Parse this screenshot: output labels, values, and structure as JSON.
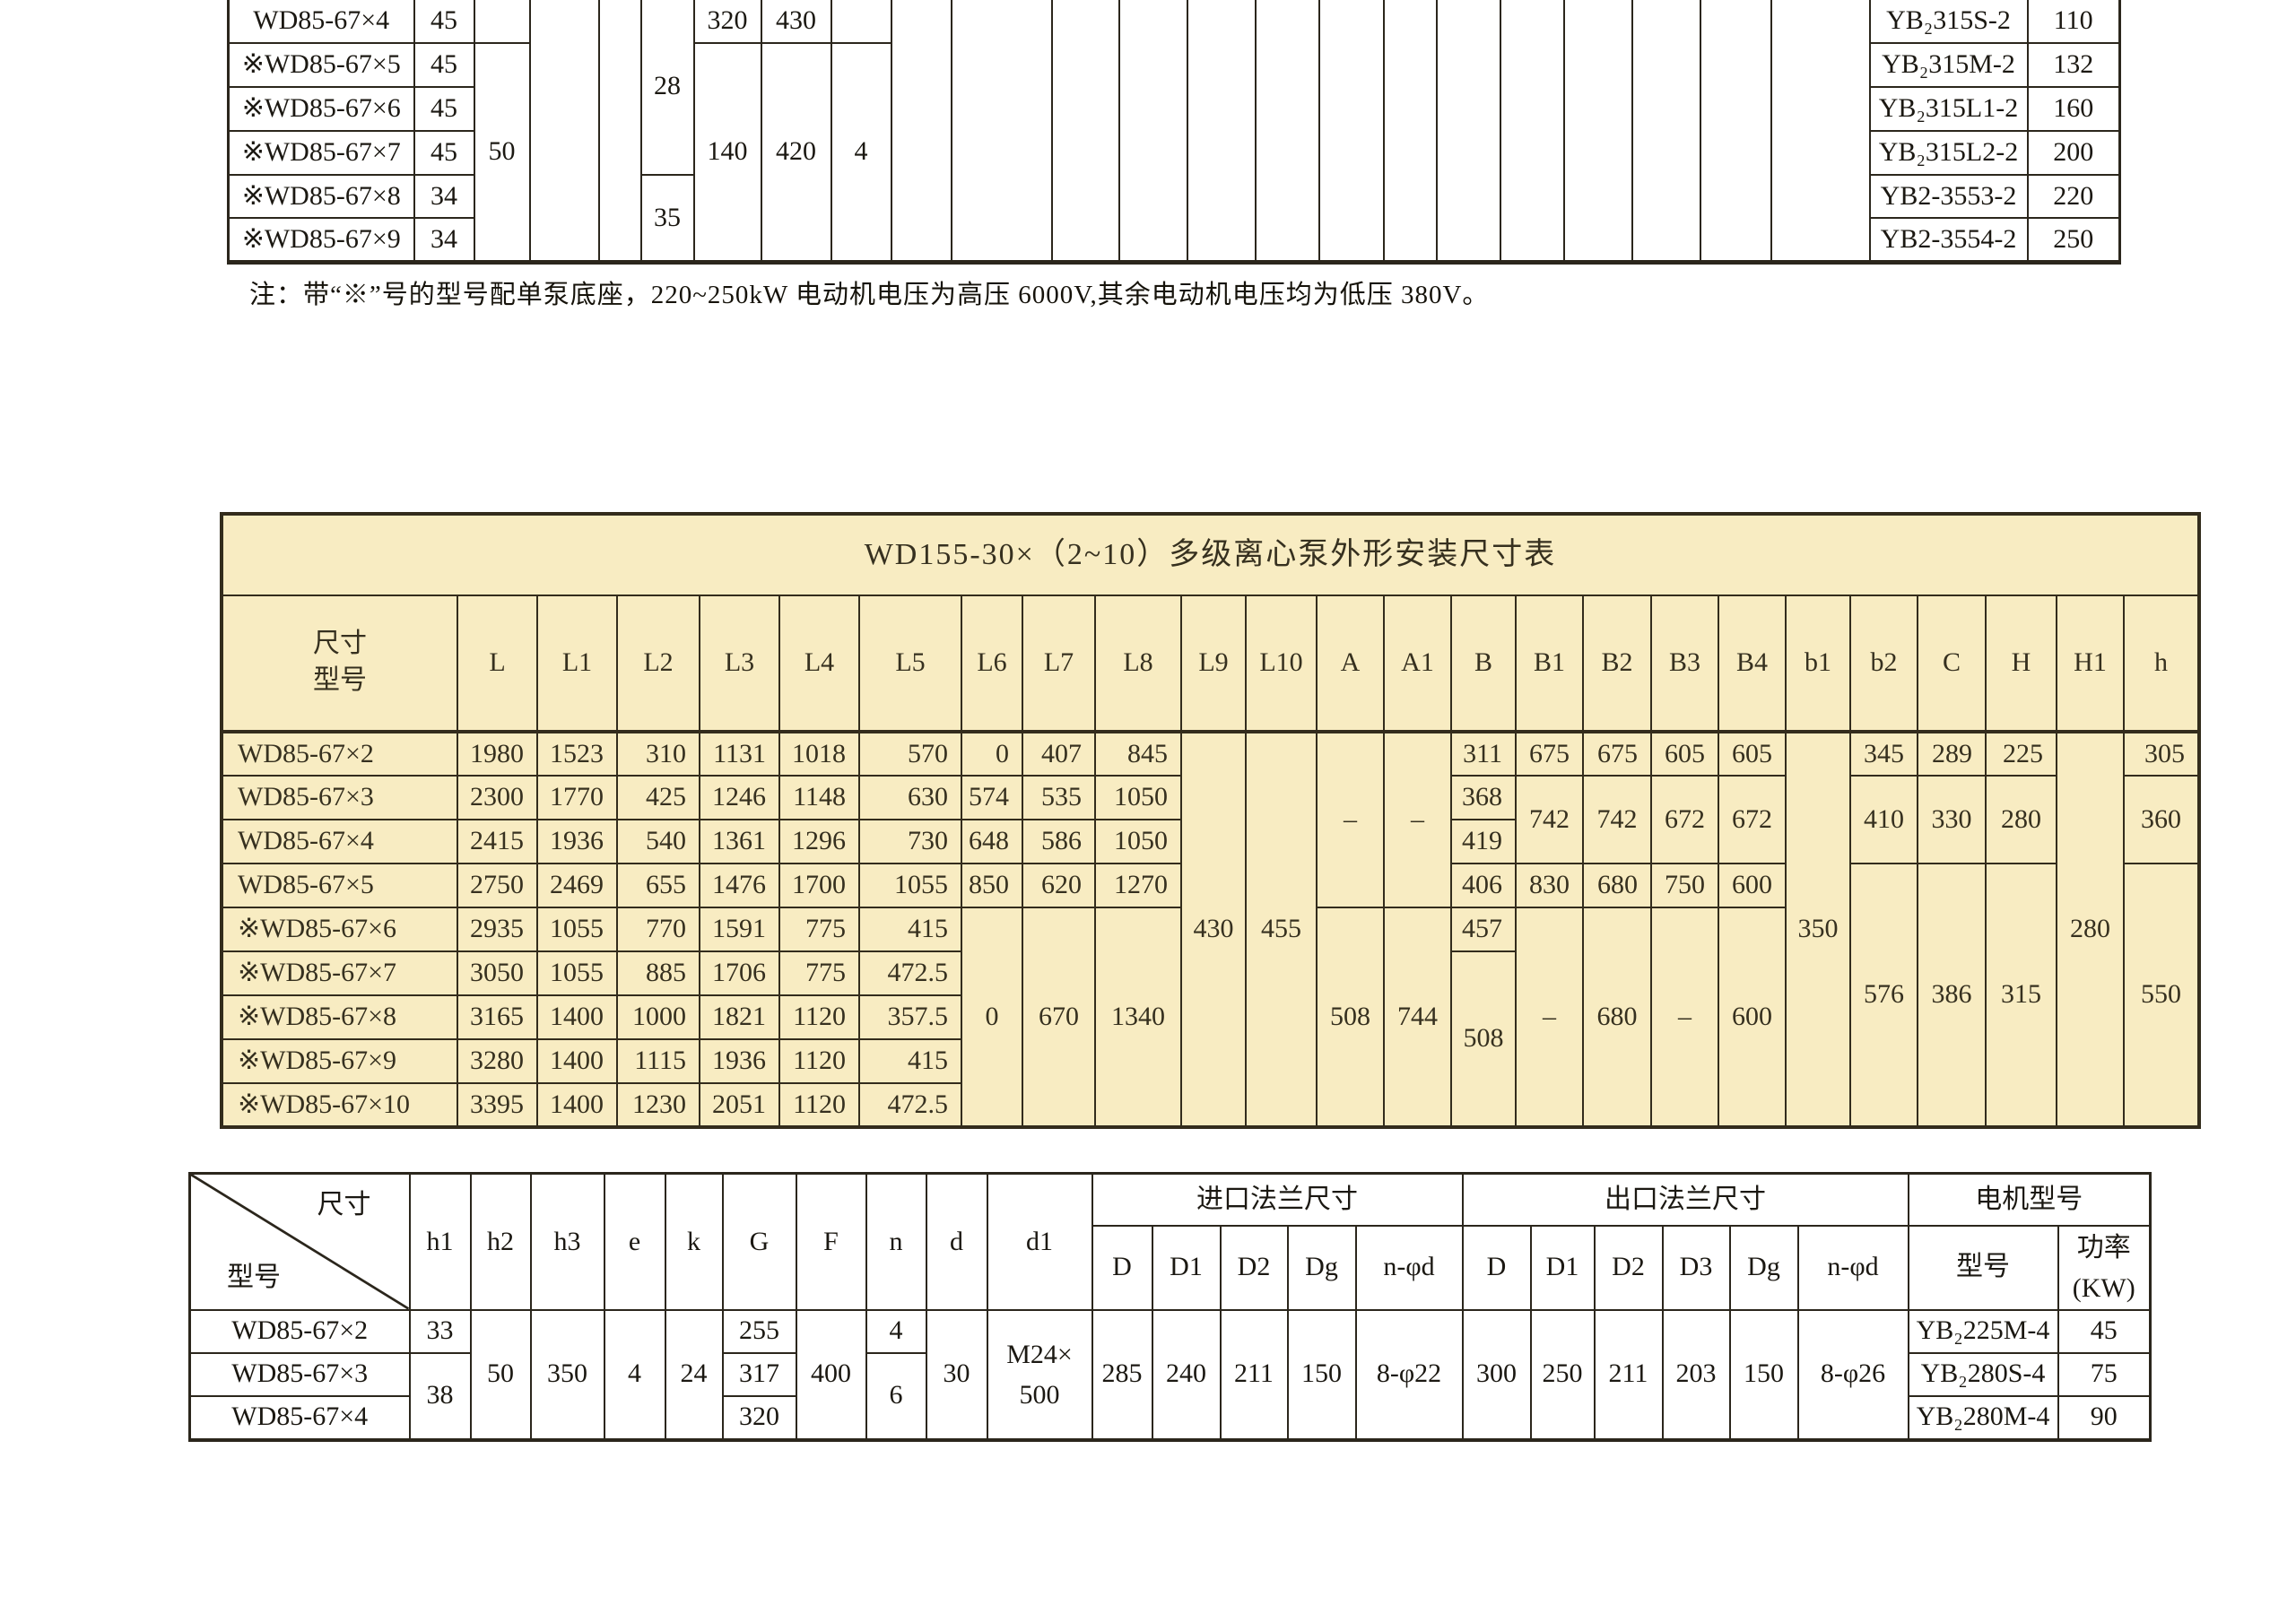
{
  "top_table": {
    "rows": [
      {
        "model": "WD85-67×4",
        "head": "45",
        "c320": "320",
        "c430": "430",
        "motor": "YB₂315S-2",
        "power": "110"
      },
      {
        "model": "※WD85-67×5",
        "head": "45",
        "motor": "YB₂315M-2",
        "power": "132"
      },
      {
        "model": "※WD85-67×6",
        "head": "45",
        "motor": "YB₂315L1-2",
        "power": "160"
      },
      {
        "model": "※WD85-67×7",
        "head": "45",
        "motor": "YB₂315L2-2",
        "power": "200"
      },
      {
        "model": "※WD85-67×8",
        "head": "34",
        "motor": "YB2-3553-2",
        "power": "220"
      },
      {
        "model": "※WD85-67×9",
        "head": "34",
        "motor": "YB2-3554-2",
        "power": "250"
      }
    ],
    "merged": {
      "c50": "50",
      "c28": "28",
      "c35": "35",
      "c140": "140",
      "c420": "420",
      "c4": "4"
    }
  },
  "note": "注：带“※”号的型号配单泵底座，220~250kW 电动机电压为高压 6000V,其余电动机电压均为低压 380V。",
  "middle_table": {
    "title": "WD155-30×（2~10）多级离心泵外形安装尺寸表",
    "corner": {
      "size": "尺寸",
      "model": "型号"
    },
    "cols": [
      "L",
      "L1",
      "L2",
      "L3",
      "L4",
      "L5",
      "L6",
      "L7",
      "L8",
      "L9",
      "L10",
      "A",
      "A1",
      "B",
      "B1",
      "B2",
      "B3",
      "B4",
      "b1",
      "b2",
      "C",
      "H",
      "H1",
      "h"
    ],
    "rows": [
      {
        "model": "WD85-67×2",
        "L": "1980",
        "L1": "1523",
        "L2": "310",
        "L3": "1131",
        "L4": "1018",
        "L5": "570",
        "L6": "0",
        "L7": "407",
        "L8": "845",
        "L9": "430",
        "L10": "455",
        "A": "–",
        "A1": "–",
        "B": "311",
        "B1": "675",
        "B2": "675",
        "B3": "605",
        "B4": "605",
        "b1": "350",
        "b2": "345",
        "C": "289",
        "H": "225",
        "H1": "280",
        "h": "305"
      },
      {
        "model": "WD85-67×3",
        "L": "2300",
        "L1": "1770",
        "L2": "425",
        "L3": "1246",
        "L4": "1148",
        "L5": "630",
        "L6": "574",
        "L7": "535",
        "L8": "1050",
        "B": "368",
        "B1": "742",
        "B2": "742",
        "B3": "672",
        "B4": "672",
        "b2": "410",
        "C": "330",
        "H": "280",
        "h": "360"
      },
      {
        "model": "WD85-67×4",
        "L": "2415",
        "L1": "1936",
        "L2": "540",
        "L3": "1361",
        "L4": "1296",
        "L5": "730",
        "L6": "648",
        "L7": "586",
        "L8": "1050",
        "B": "419"
      },
      {
        "model": "WD85-67×5",
        "L": "2750",
        "L1": "2469",
        "L2": "655",
        "L3": "1476",
        "L4": "1700",
        "L5": "1055",
        "L6": "850",
        "L7": "620",
        "L8": "1270",
        "B": "406",
        "B1": "830",
        "B2": "680",
        "B3": "750",
        "B4": "600",
        "b2": "576",
        "C": "386",
        "H": "315",
        "h": "550"
      },
      {
        "model": "※WD85-67×6",
        "L": "2935",
        "L1": "1055",
        "L2": "770",
        "L3": "1591",
        "L4": "775",
        "L5": "415",
        "L6": "0",
        "L7": "670",
        "L8": "1340",
        "A": "508",
        "A1": "744",
        "B": "457",
        "B1": "–",
        "B2": "680",
        "B3": "–",
        "B4": "600"
      },
      {
        "model": "※WD85-67×7",
        "L": "3050",
        "L1": "1055",
        "L2": "885",
        "L3": "1706",
        "L4": "775",
        "L5": "472.5",
        "B": "508"
      },
      {
        "model": "※WD85-67×8",
        "L": "3165",
        "L1": "1400",
        "L2": "1000",
        "L3": "1821",
        "L4": "1120",
        "L5": "357.5"
      },
      {
        "model": "※WD85-67×9",
        "L": "3280",
        "L1": "1400",
        "L2": "1115",
        "L3": "1936",
        "L4": "1120",
        "L5": "415"
      },
      {
        "model": "※WD85-67×10",
        "L": "3395",
        "L1": "1400",
        "L2": "1230",
        "L3": "2051",
        "L4": "1120",
        "L5": "472.5"
      }
    ]
  },
  "bottom_table": {
    "corner": {
      "size": "尺寸",
      "model": "型号"
    },
    "cols1": [
      "h1",
      "h2",
      "h3",
      "e",
      "k",
      "G",
      "F",
      "n",
      "d",
      "d1"
    ],
    "groups": {
      "inlet": "进口法兰尺寸",
      "outlet": "出口法兰尺寸",
      "motor": "电机型号"
    },
    "sub_in": [
      "D",
      "D1",
      "D2",
      "Dg",
      "n-φd"
    ],
    "sub_out": [
      "D",
      "D1",
      "D2",
      "D3",
      "Dg",
      "n-φd"
    ],
    "motor_col": "型号",
    "power_col": [
      "功率",
      "(KW)"
    ],
    "rows": [
      {
        "model": "WD85-67×2",
        "h1": "33",
        "G": "255",
        "n": "4",
        "motor": "YB₂225M-4",
        "power": "45"
      },
      {
        "model": "WD85-67×3",
        "h1": "38",
        "G": "317",
        "n": "6",
        "motor": "YB₂280S-4",
        "power": "75"
      },
      {
        "model": "WD85-67×4",
        "G": "320",
        "motor": "YB₂280M-4",
        "power": "90"
      }
    ],
    "merged": {
      "h2": "50",
      "h3": "350",
      "e": "4",
      "k": "24",
      "F": "400",
      "d": "30",
      "d1": [
        "M24×",
        "500"
      ],
      "inD": "285",
      "inD1": "240",
      "inD2": "211",
      "inDg": "150",
      "inN": "8-φ22",
      "outD": "300",
      "outD1": "250",
      "outD2": "211",
      "outD3": "203",
      "outDg": "150",
      "outN": "8-φ26"
    }
  },
  "colors": {
    "table_bg": "#f8ecc2",
    "line_dark": "#2b261c",
    "line_mid": "#332c1c"
  }
}
